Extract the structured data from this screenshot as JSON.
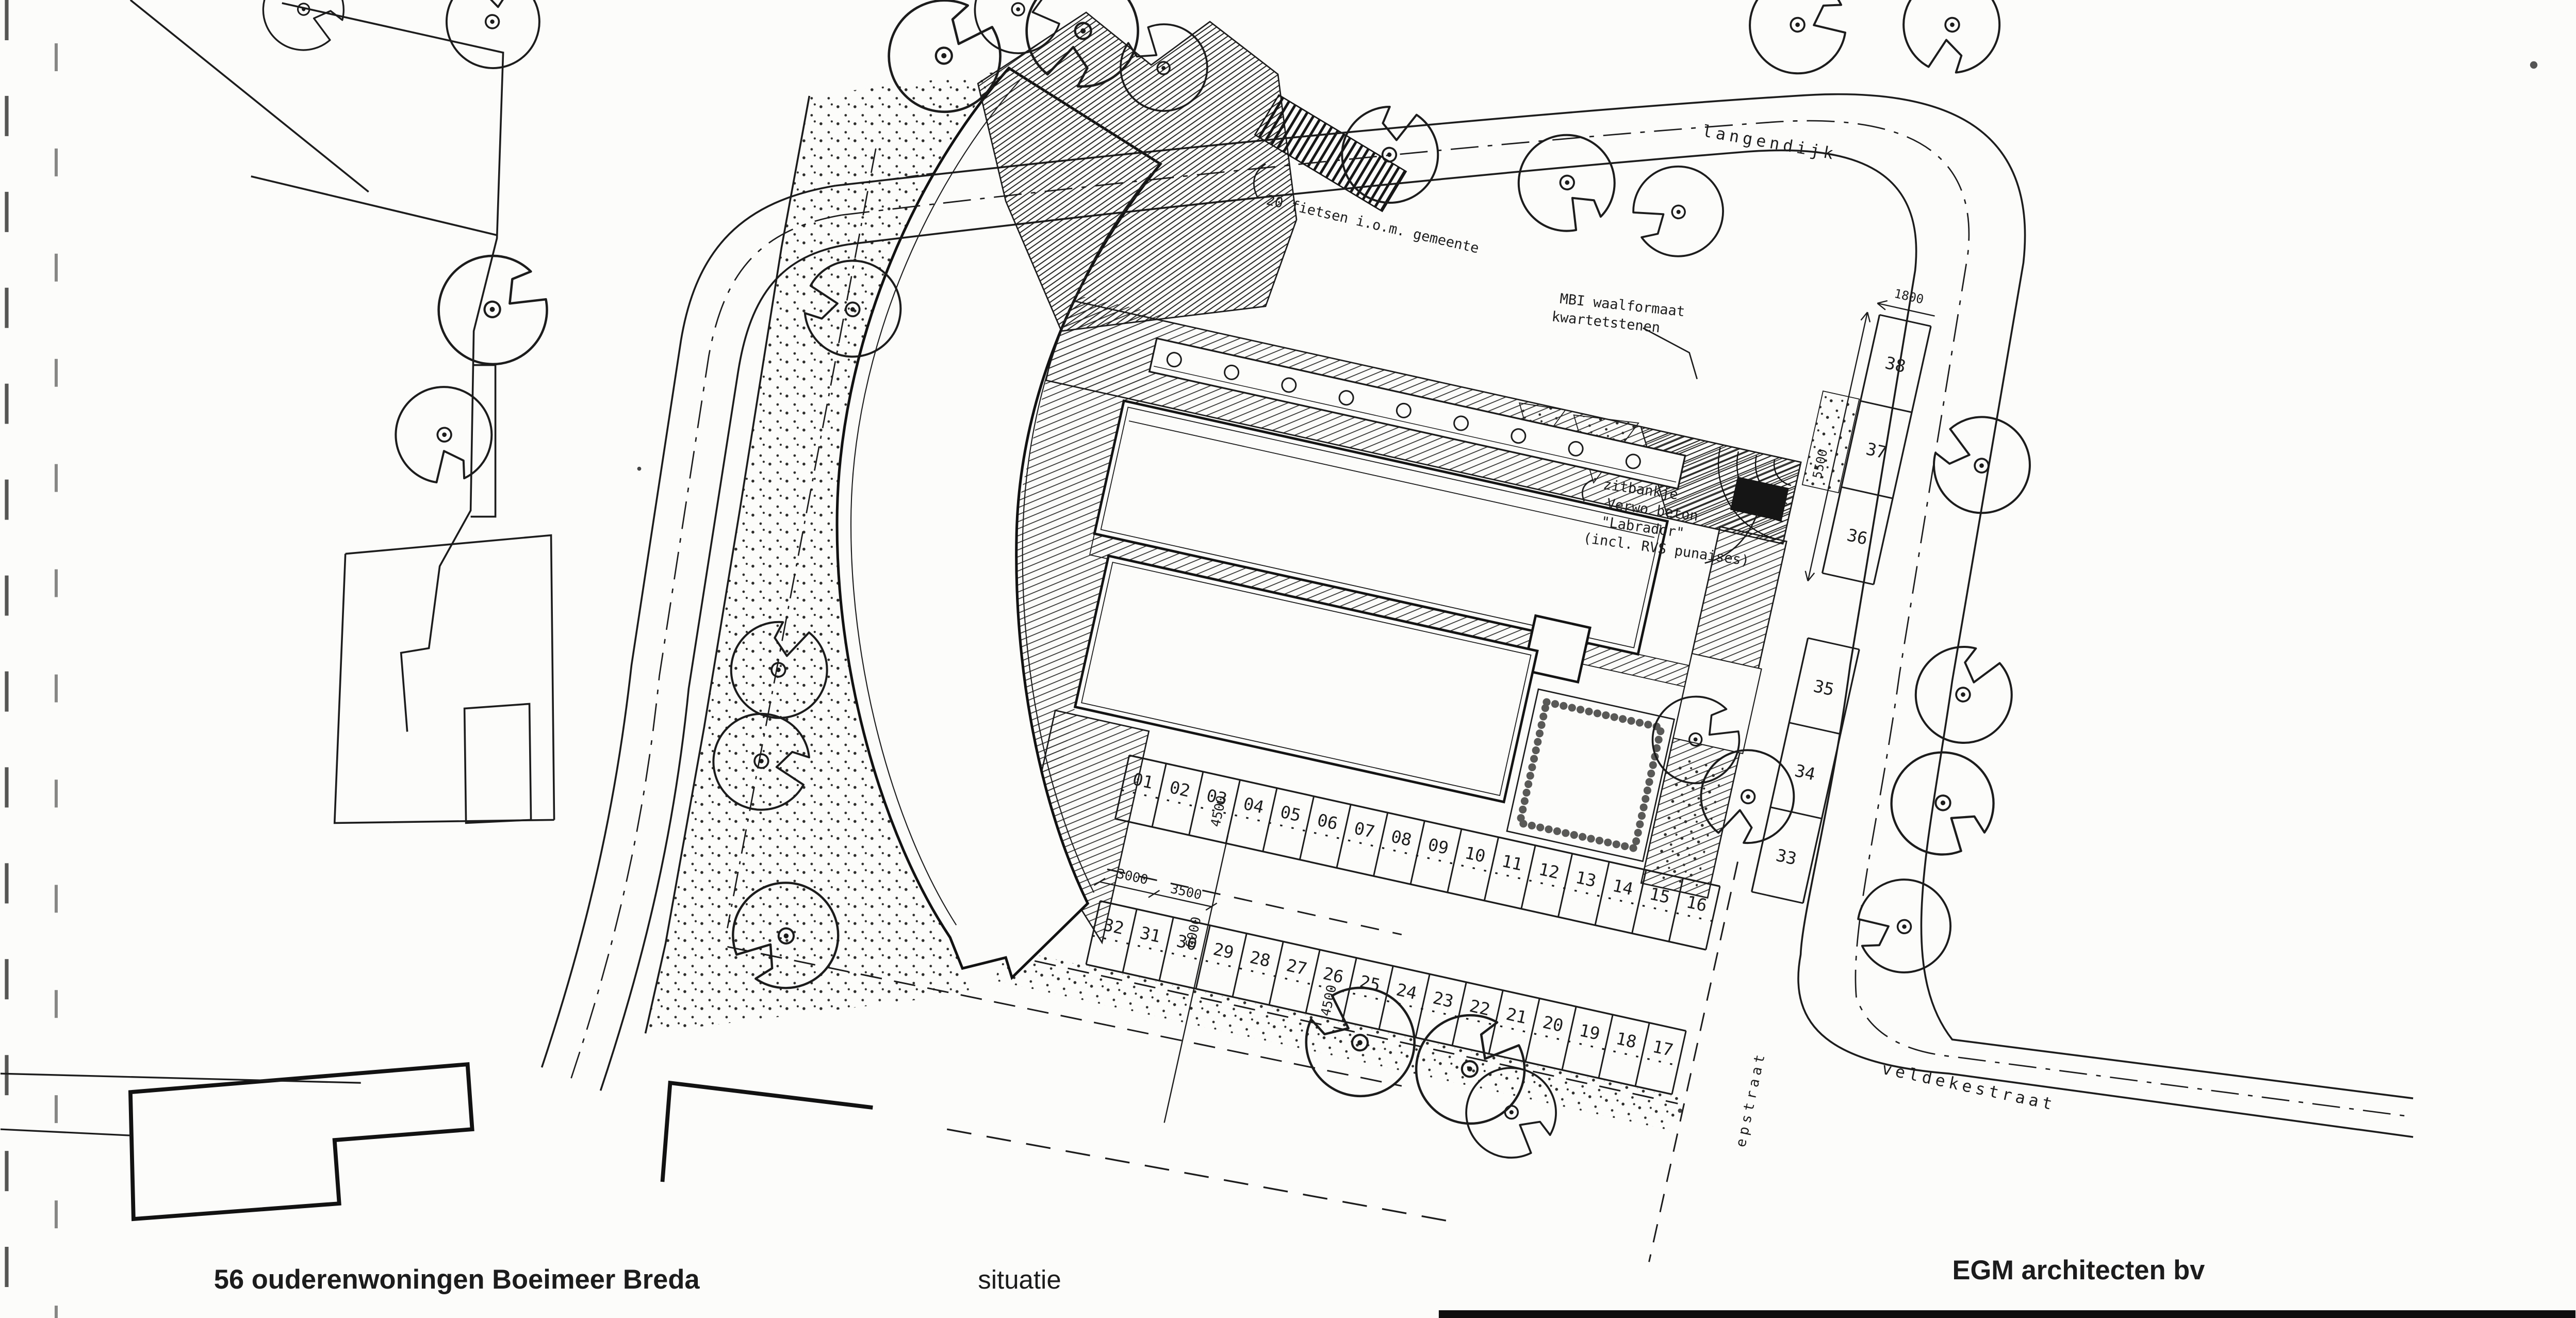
{
  "title_block": {
    "project": "56 ouderenwoningen Boeimeer Breda",
    "drawing_label": "situatie",
    "firm": "EGM architecten bv"
  },
  "streets": {
    "north": "langendijk",
    "southeast": "veldekestraat",
    "east_vertical": "epstraat"
  },
  "annotations": {
    "bikes": "20 fietsen i.o.m. gemeente",
    "paving_line1": "MBI waalformaat",
    "paving_line2": "kwartetstenen",
    "bench_line1": "zitbankje",
    "bench_line2": "Verwo beton",
    "bench_line3": "\"Labrador\"",
    "bench_line4": "(incl. RVS punaises)"
  },
  "dimensions": {
    "d3000": "3000",
    "d3500": "3500",
    "d4500_north_row": "4500",
    "d6000_aisle": "6000",
    "d4500_south_row": "4500",
    "d1800_east_stall_width": "1800",
    "d5500_east_stall_length": "5500"
  },
  "parking": {
    "row_north": [
      "01",
      "02",
      "03",
      "04",
      "05",
      "06",
      "07",
      "08",
      "09",
      "10",
      "11",
      "12",
      "13",
      "14",
      "15",
      "16"
    ],
    "row_south": [
      "32",
      "31",
      "30",
      "29",
      "28",
      "27",
      "26",
      "25",
      "24",
      "23",
      "22",
      "21",
      "20",
      "19",
      "18",
      "17"
    ],
    "row_east": [
      "38",
      "37",
      "36",
      "35",
      "34",
      "33"
    ]
  },
  "drawing_colors": {
    "ink": "#1c1c1c",
    "paper": "#fcfcfa"
  }
}
